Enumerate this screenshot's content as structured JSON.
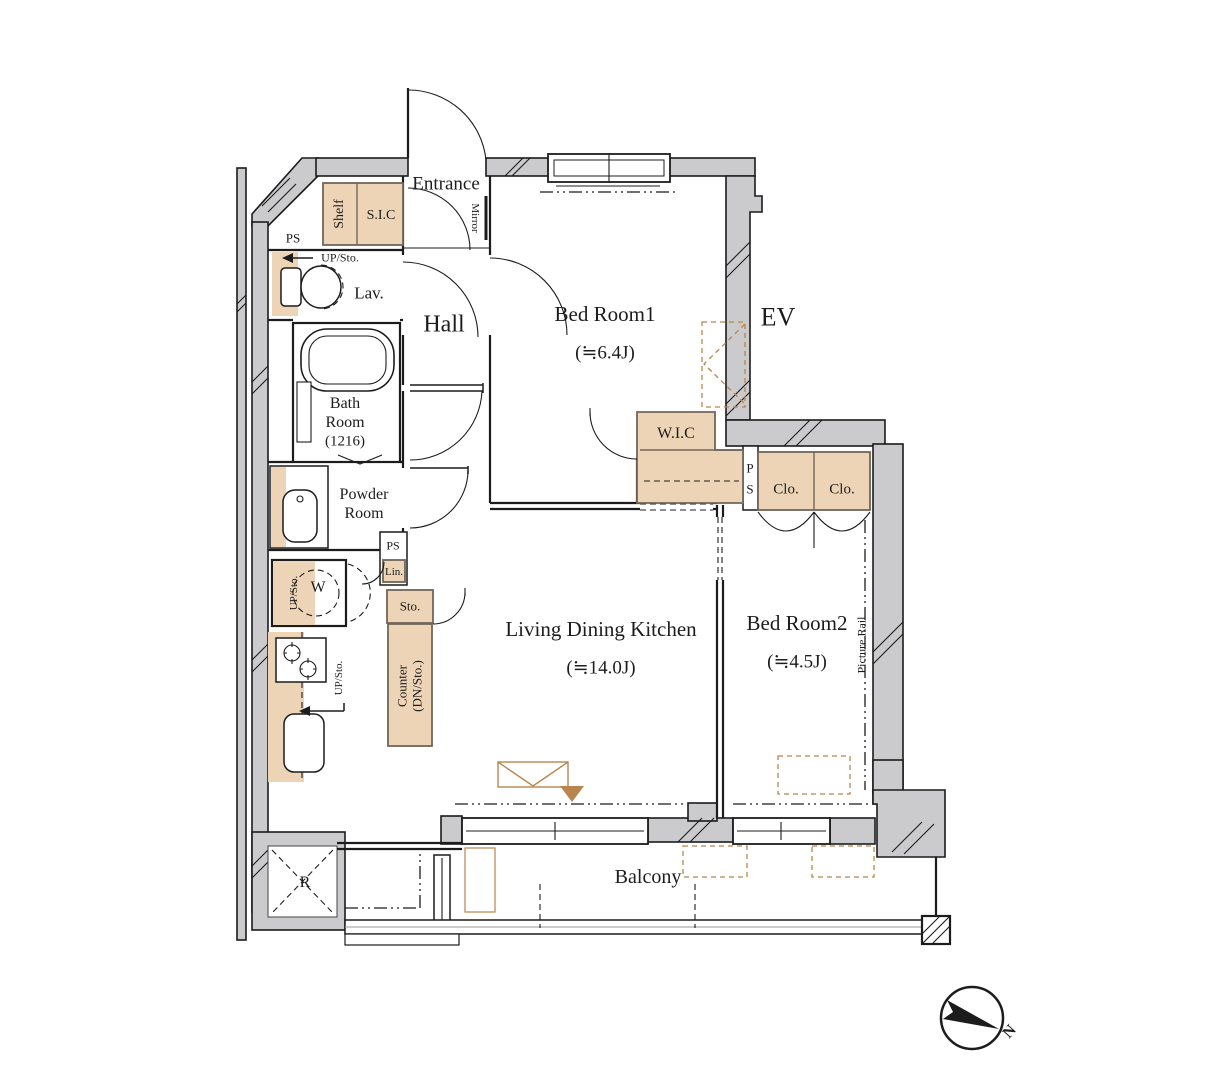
{
  "colors": {
    "wall-fill": "#cbcbce",
    "fixture-fill": "#eed4b6",
    "fixture-border": "#70665a",
    "accent-brown": "#b9854c"
  },
  "floorplan": {
    "rooms": {
      "entrance": {
        "label": "Entrance"
      },
      "hall": {
        "label": "Hall"
      },
      "bedroom1": {
        "label": "Bed Room1",
        "size": "(≒6.4J)"
      },
      "bedroom2": {
        "label": "Bed Room2",
        "size": "(≒4.5J)"
      },
      "ldk": {
        "label": "Living Dining Kitchen",
        "size": "(≒14.0J)"
      },
      "bathroom": {
        "line1": "Bath",
        "line2": "Room",
        "line3": "(1216)"
      },
      "powder_room": {
        "line1": "Powder",
        "line2": "Room"
      },
      "lavatory": {
        "label": "Lav."
      },
      "wic": {
        "label": "W.I.C"
      },
      "sic": {
        "label": "S.I.C"
      },
      "balcony": {
        "label": "Balcony"
      },
      "elevator": {
        "label": "EV"
      }
    },
    "fixtures": {
      "shelf": "Shelf",
      "mirror": "Mirror",
      "closet_left": "Clo.",
      "closet_right": "Clo.",
      "pipe_space_top": "PS",
      "pipe_space_mid": "PS",
      "pipe_shaft_p": "P",
      "pipe_shaft_s": "S",
      "linen": "Lin.",
      "storage": "Sto.",
      "counter_line1": "Counter",
      "counter_line2": "(DN/Sto.)",
      "up_storage_lavatory": "UP/Sto.",
      "up_storage_washer": "UP/Sto.",
      "up_storage_kitchen": "UP/Sto.",
      "washing_machine": "W",
      "refrigerator": "R",
      "picture_rail": "Picture Rail"
    },
    "compass": {
      "north": "N"
    }
  }
}
